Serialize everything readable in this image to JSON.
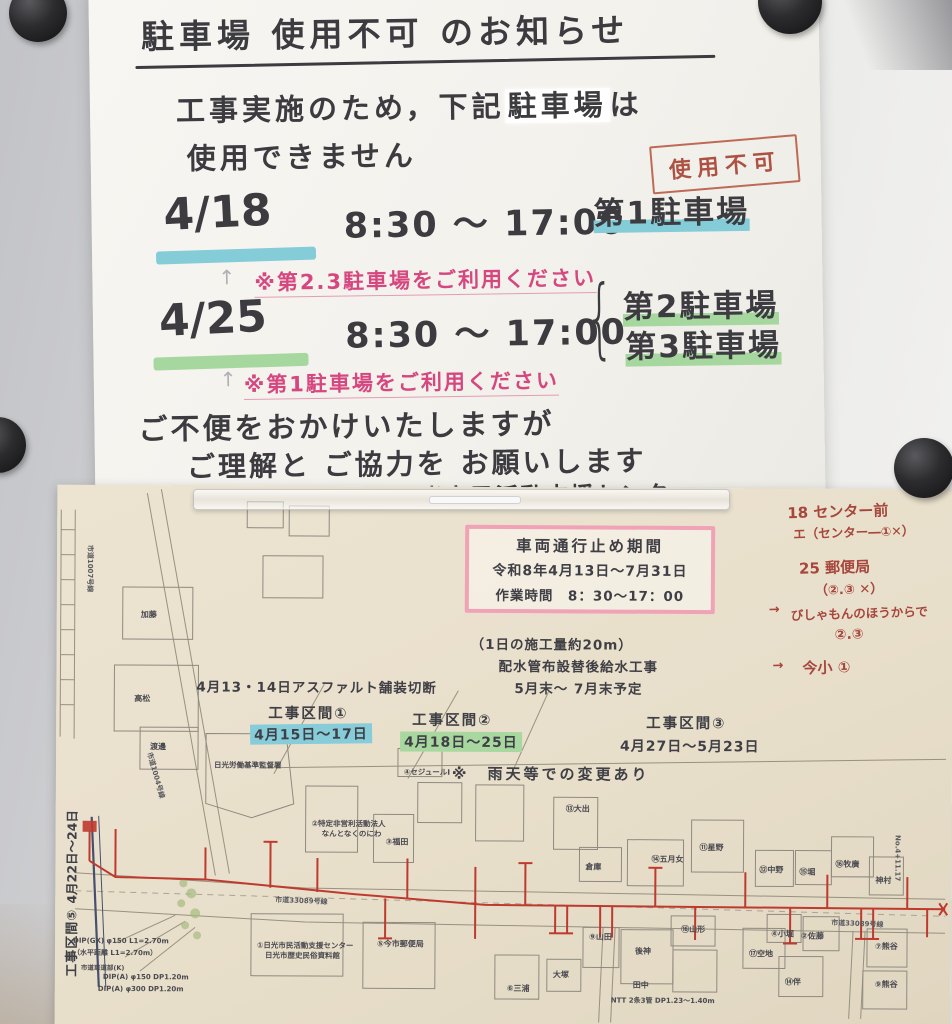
{
  "notice": {
    "title": "駐車場 使用不可 のお知らせ",
    "line1_pre": "工事実施のため，下記",
    "line1_highlight": "駐車場",
    "line1_post": "は",
    "line2": "使用できません",
    "badge": "使用不可",
    "brace": "{",
    "pencil_arrow": "↑",
    "rows": [
      {
        "date": "4/18",
        "time": "8:30 〜 17:00",
        "lot1": "第1駐車場",
        "note": "※第2.3駐車場をご利用ください"
      },
      {
        "date": "4/25",
        "time": "8:30 〜 17:00",
        "lot1": "第2駐車場",
        "lot2": "第3駐車場",
        "note": "※第1駐車場をご利用ください"
      }
    ],
    "closing1": "ご不便をおかけいたしますが",
    "closing2": "ご理解と ご協力を お願いします",
    "signature": "日光市民活動支援センター ―"
  },
  "map": {
    "closure": {
      "title": "車両通行止め期間",
      "period": "令和8年4月13日〜7月31日",
      "hours": "作業時間　8：30〜17：00"
    },
    "notes": {
      "daily": "（1日の施工量約20m）",
      "work": "配水管布設替後給水工事",
      "schedule": "5月末〜 7月末予定",
      "asphalt": "4月13・14日アスファルト舗装切断",
      "weather": "※　雨天等での変更あり"
    },
    "sections": [
      {
        "name": "工事区間①",
        "dates": "4月15日〜17日"
      },
      {
        "name": "工事区間②",
        "dates": "4月18日〜25日"
      },
      {
        "name": "工事区間③",
        "dates": "4月27日〜5月23日"
      },
      {
        "name": "工事区間⑤",
        "dates": "4月22日〜24日"
      }
    ],
    "memo": {
      "l1": "18 センター前",
      "l2": "エ（センター―①✕）",
      "l3": "25 郵便局",
      "l4": "（②.③ ✕）",
      "l5": "びしゃもんのほうからで",
      "l6": "②.③",
      "l7": "今小 ①",
      "arrow1": "→",
      "arrow2": "→"
    },
    "roads": [
      "市道1007号線",
      "市道1004号線",
      "市道33089号線",
      "市道33089号線"
    ],
    "station": "No.4+11.17",
    "pipes": [
      "DIP(GX) φ150 L1=2.70m",
      "（水平距離 L1=2.70m）",
      "市道車道部(K)",
      "DIP(A) φ150 DP1.20m",
      "DIP(A) φ300 DP1.20m",
      "NTT 2条3管 DP1.23〜1.40m"
    ],
    "buildings": [
      "加藤",
      "高松",
      "渡邊",
      "日光労働基準監督署",
      "②特定非営利活動法人",
      "なんとなくのにわ",
      "③福田",
      "①日光市民活動支援センター",
      "日光市歴史民俗資料館",
      "⑤今市郵便局",
      "④セジュールⅠ",
      "⑬大出",
      "倉庫",
      "⑭五月女",
      "⑪星野",
      "⑫中野",
      "⑮堀",
      "⑯牧廣",
      "神村",
      "⑨山田",
      "後神",
      "田中",
      "⑯山形",
      "⑰空地",
      "④小堀",
      "②佐藤",
      "⑭伴",
      "⑦熊谷",
      "⑨熊谷",
      "⑥三浦",
      "大塚"
    ]
  }
}
